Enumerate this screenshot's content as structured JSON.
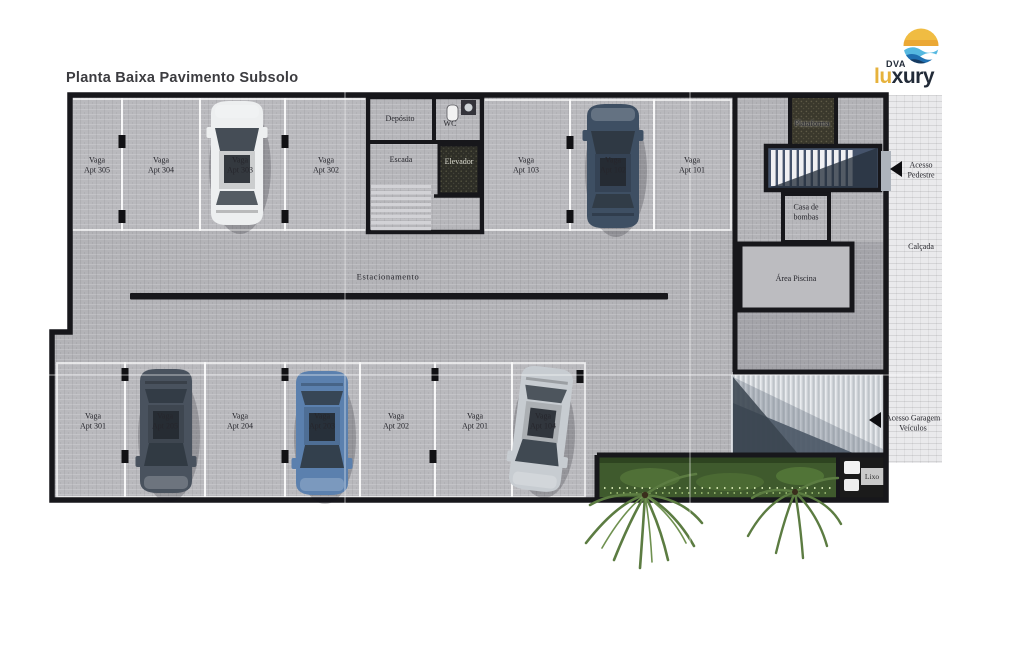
{
  "title": "Planta Baixa Pavimento Subsolo",
  "logo": {
    "dva": "DVA",
    "lu": "lu",
    "xury": "xury"
  },
  "areas": {
    "estacionamento": "Estacionamento",
    "deposito": "Depósito",
    "wc": "WC",
    "escada": "Escada",
    "elevador": "Elevador",
    "plataforma": "Plataforma",
    "casa_de_bombas": "Casa de\nbombas",
    "area_piscina": "Área Piscina",
    "calcada": "Calçada",
    "acesso_pedestre": "Acesso\nPedestre",
    "acesso_garagem_veiculos": "Acesso Garagem\nVeículos",
    "lixo": "Lixo"
  },
  "stalls": {
    "top": [
      {
        "label": "Vaga\nApt 305"
      },
      {
        "label": "Vaga\nApt 304"
      },
      {
        "label": "Vaga\nApt 303"
      },
      {
        "label": "Vaga\nApt 302"
      },
      {
        "label": "Vaga\nApt 103"
      },
      {
        "label": "Vaga\nApt 102"
      },
      {
        "label": "Vaga\nApt 101"
      }
    ],
    "bottom": [
      {
        "label": "Vaga\nApt 301"
      },
      {
        "label": "Vaga\nApt 205"
      },
      {
        "label": "Vaga\nApt 204"
      },
      {
        "label": "Vaga\nApt 203"
      },
      {
        "label": "Vaga\nApt 202"
      },
      {
        "label": "Vaga\nApt 201"
      },
      {
        "label": "Vaga\nApt 104"
      }
    ]
  },
  "cars": [
    {
      "stall": "Apt 303",
      "color": "#edeff0"
    },
    {
      "stall": "Apt 102",
      "color": "#3e4f63"
    },
    {
      "stall": "Apt 205",
      "color": "#49525e"
    },
    {
      "stall": "Apt 203",
      "color": "#5b80ae"
    },
    {
      "stall": "Apt 104",
      "color": "#c7ccd1"
    }
  ],
  "colors": {
    "wall": "#17171b",
    "floor": "#b3b3b7",
    "sidewalk": "#eaeaec",
    "ramp": "#ccd0d5",
    "green_area": "#3f5a2d",
    "brand_yellow": "#e6b23c",
    "brand_navy": "#222b38"
  }
}
